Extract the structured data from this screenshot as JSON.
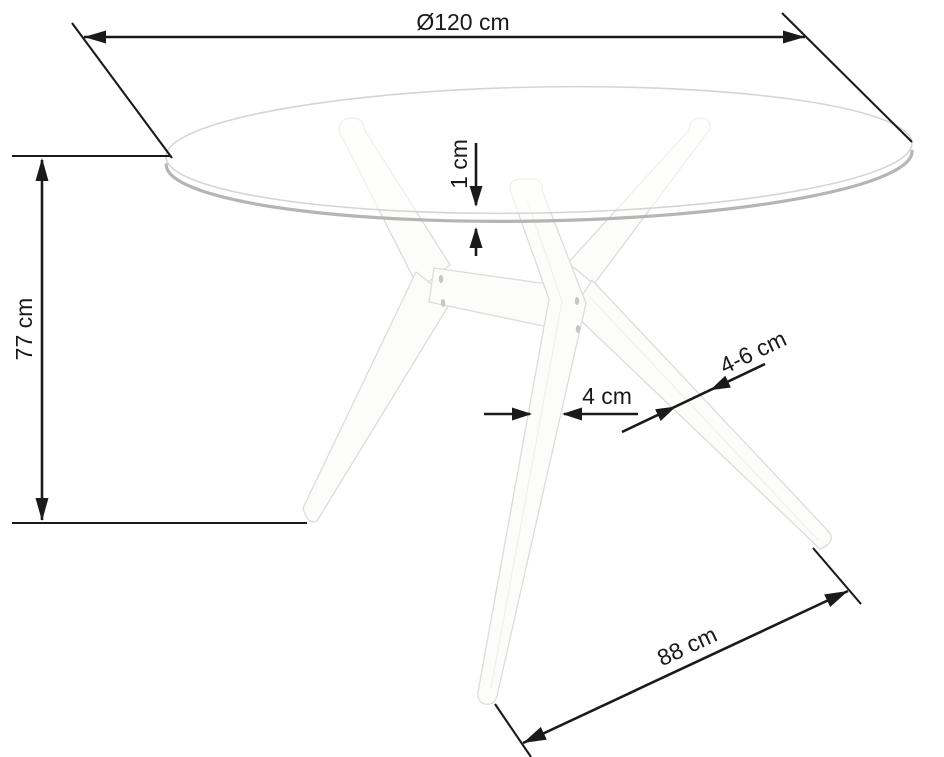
{
  "diagram": {
    "subject": "Round glass-top table dimension drawing",
    "labels": {
      "diameter": "Ø120 cm",
      "height": "77 cm",
      "glass_thickness": "1 cm",
      "leg_width": "4 cm",
      "leg_profile": "4-6 cm",
      "base_span": "88 cm"
    },
    "colors": {
      "ink": "#1a1a1a",
      "background": "#ffffff",
      "glass_outline": "#d5d5d5",
      "glass_rim": "#b5b5b5",
      "leg_fill": "#fcfcfb",
      "leg_outline": "#dcdcdc",
      "dowel": "#c6c6c6"
    }
  }
}
